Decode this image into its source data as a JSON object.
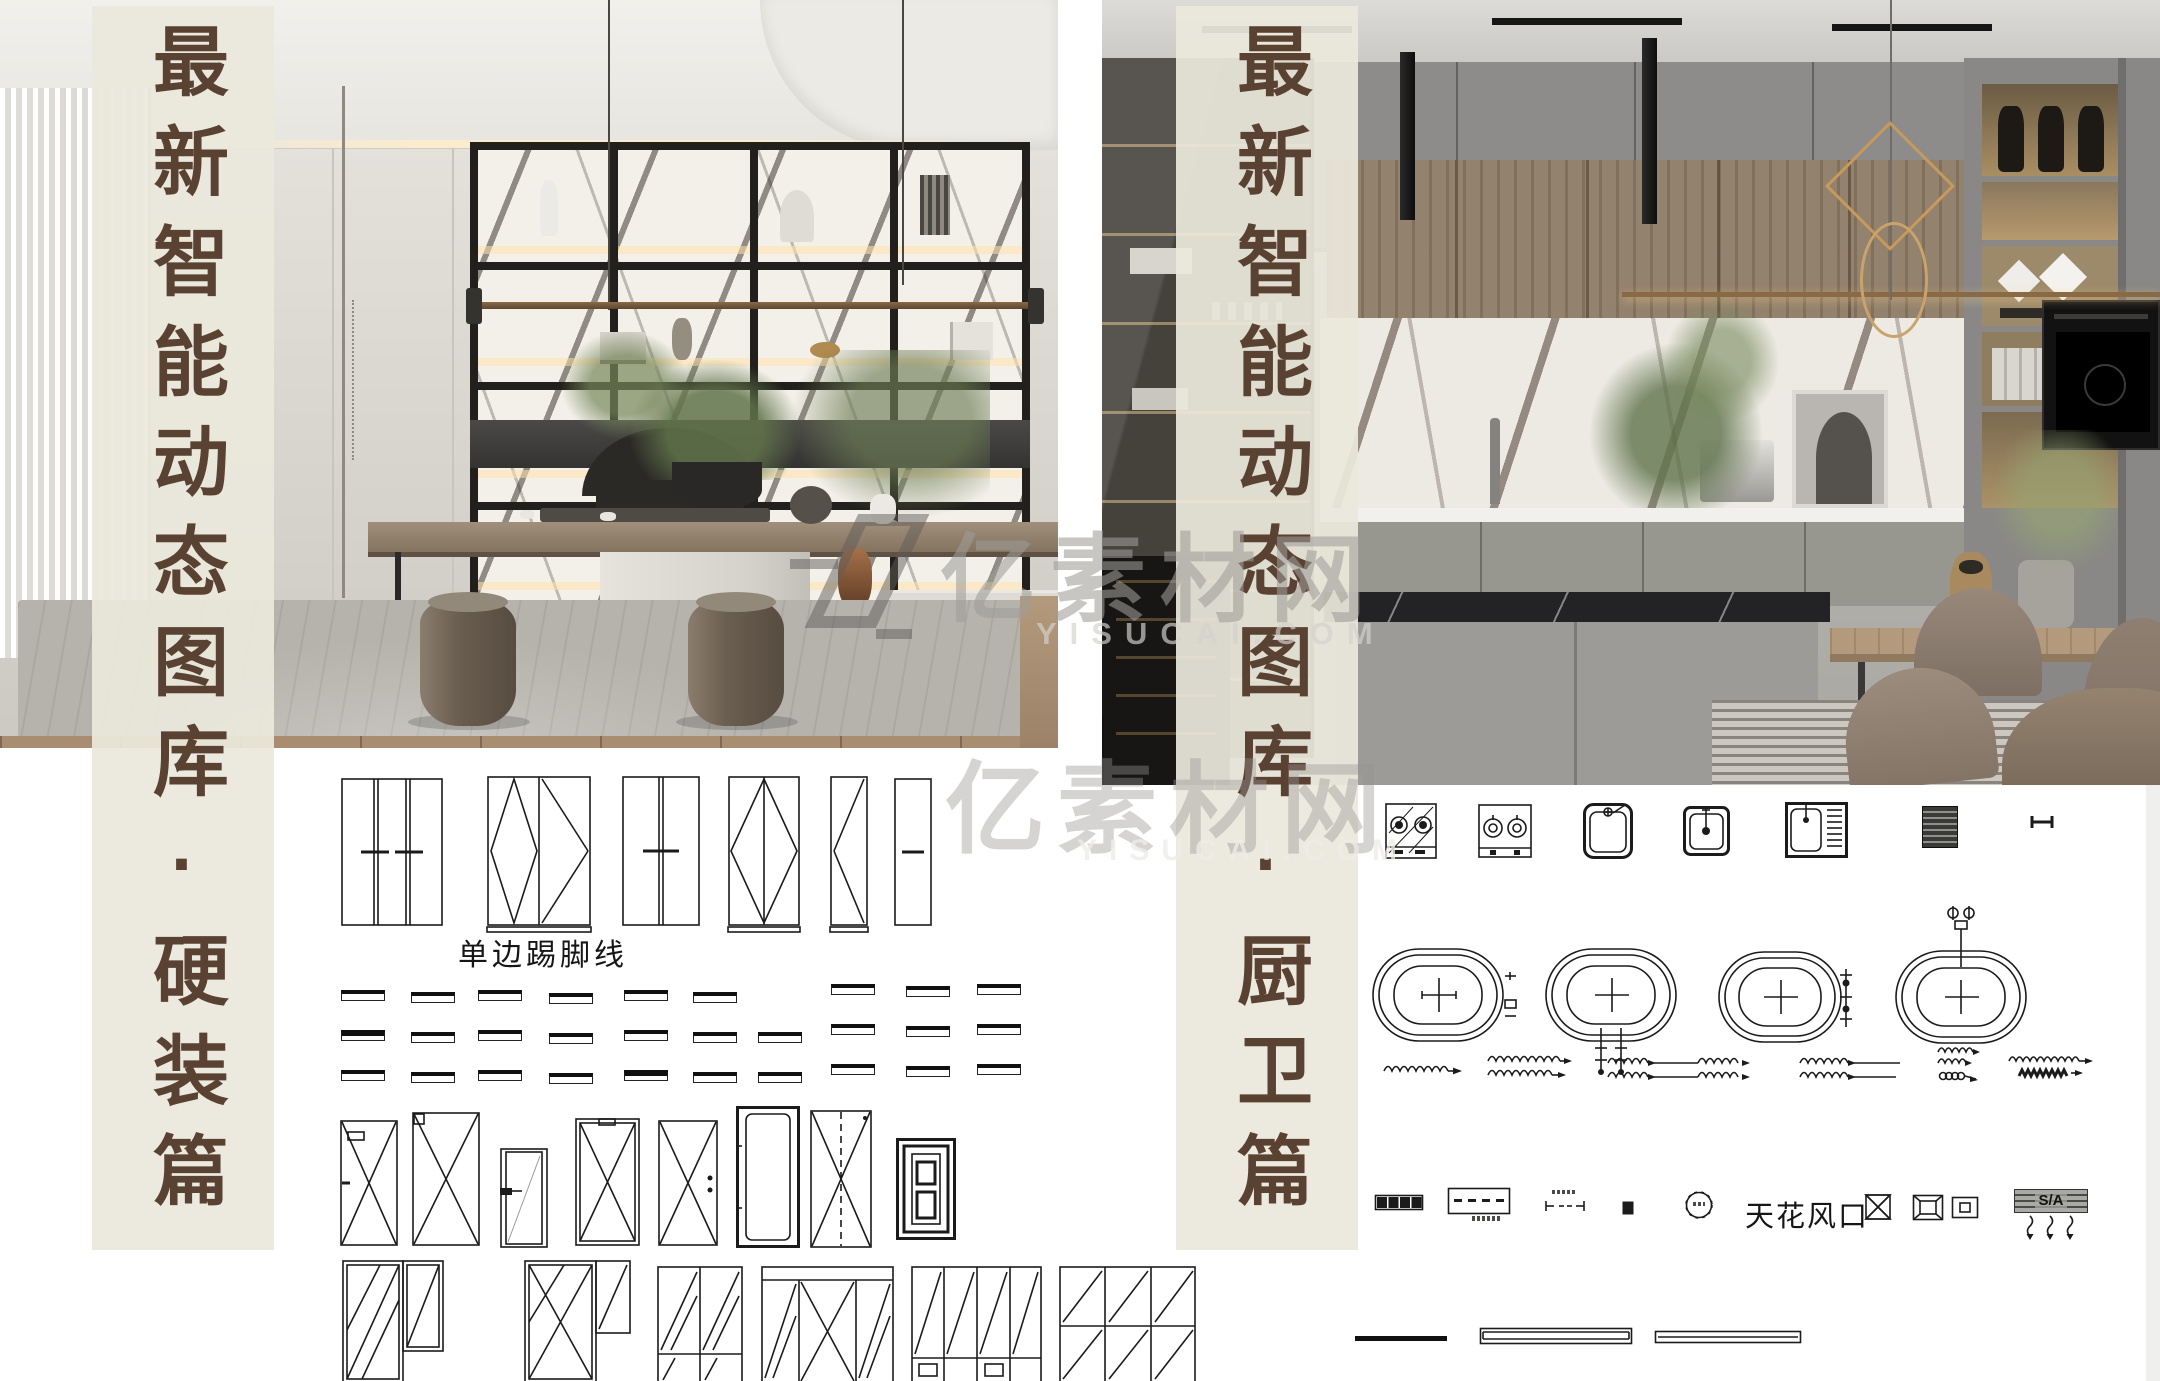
{
  "banners": {
    "left": "最新智能动态图库·硬装篇",
    "right": "最新智能动态图库·厨卫篇"
  },
  "labels": {
    "skirting": "单边踢脚线",
    "ceiling_vent": "天花风口",
    "air_supply": "S/A"
  },
  "watermark": {
    "brand": "亿素材网",
    "domain": "YISUCAI.COM"
  },
  "colors": {
    "banner_bg": "#ebe8dc",
    "banner_text": "#5a4233",
    "cad_line": "#1b1b1b",
    "page_bg": "#ffffff"
  }
}
